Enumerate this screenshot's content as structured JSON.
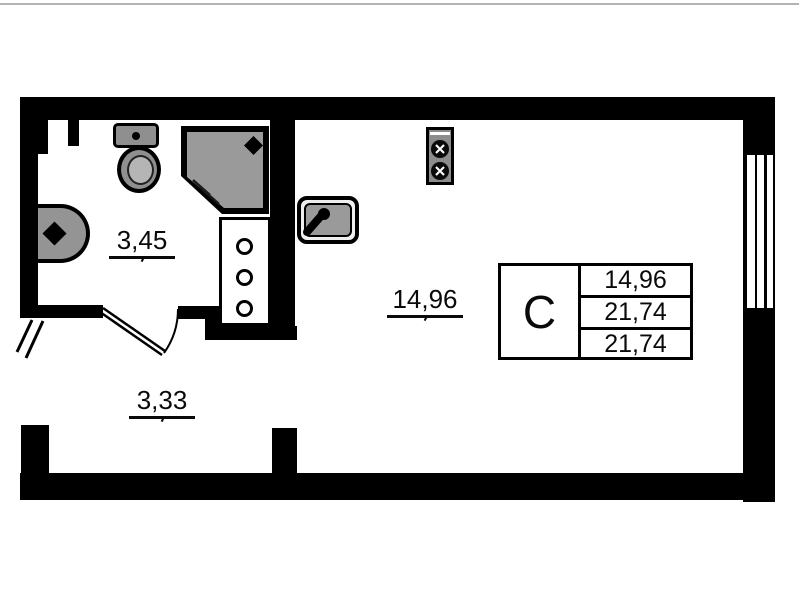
{
  "rooms": {
    "bathroom": {
      "area": "3,45"
    },
    "hallway": {
      "area": "3,33"
    },
    "living": {
      "area": "14,96"
    }
  },
  "legend": {
    "unit_type": "С",
    "values": [
      "14,96",
      "21,74",
      "21,74"
    ]
  },
  "fixtures": {
    "icons": [
      "toilet-icon",
      "washbasin-icon",
      "shower-cabin-icon",
      "kitchen-sink-icon",
      "stove-two-burner-icon",
      "ventilation-shaft-icon",
      "window",
      "entrance-door",
      "bathroom-door"
    ]
  },
  "colors": {
    "wall": "#000000",
    "fixture_gray": "#949494",
    "background": "#ffffff"
  }
}
